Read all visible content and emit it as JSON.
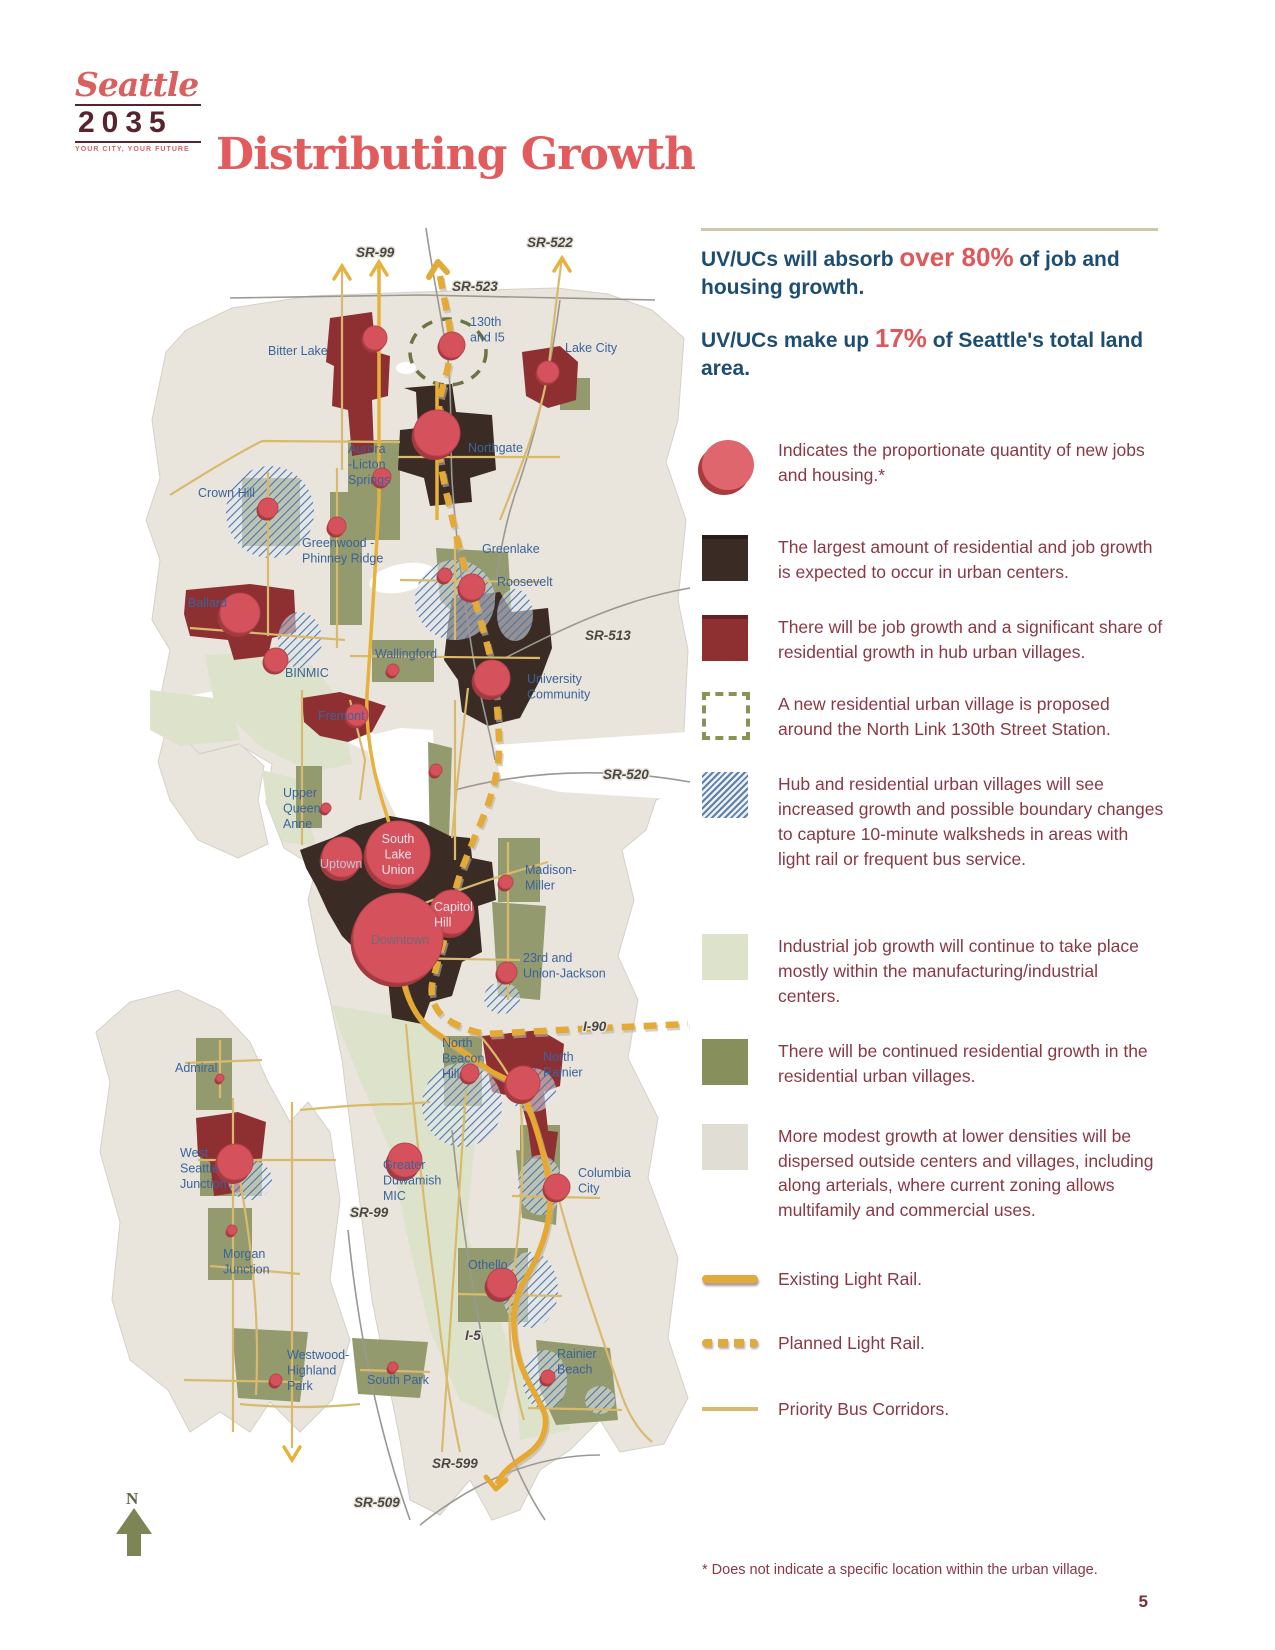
{
  "logo": {
    "brand": "Seattle",
    "year": "2035",
    "tagline": "YOUR CITY, YOUR FUTURE"
  },
  "header": {
    "title": "Distributing Growth"
  },
  "stats": [
    {
      "prefix": "UV/UCs will absorb ",
      "highlight": "over 80%",
      "suffix": " of job and housing growth."
    },
    {
      "prefix": "UV/UCs make up ",
      "highlight": "17%",
      "suffix": " of Seattle's total land area."
    }
  ],
  "legend": {
    "items": [
      {
        "type": "proportional-circle",
        "text": "Indicates the proportionate quantity of new jobs and housing.*"
      },
      {
        "type": "urban-center",
        "text": "The largest amount of residential and job growth is expected to occur in urban centers."
      },
      {
        "type": "hub-urban-village",
        "text": "There will be job growth and a significant share of residential growth in hub urban villages."
      },
      {
        "type": "proposed-village",
        "text": "A new residential urban village is proposed around the North Link 130th Street Station."
      },
      {
        "type": "boundary-change-hatch",
        "text": "Hub and residential urban villages will see increased growth and possible boundary changes to capture 10-minute walksheds in areas with light rail or frequent bus service."
      },
      {
        "type": "industrial-center",
        "text": "Industrial job growth will continue to take place mostly within the manufacturing/industrial centers."
      },
      {
        "type": "residential-urban-village",
        "text": "There will be continued residential growth in the residential urban villages."
      },
      {
        "type": "dispersed-growth",
        "text": "More modest growth at lower densities will be dispersed outside centers and villages, including along arterials, where current zoning allows multifamily and commercial uses."
      },
      {
        "type": "existing-light-rail",
        "text": "Existing Light Rail."
      },
      {
        "type": "planned-light-rail",
        "text": "Planned Light Rail."
      },
      {
        "type": "priority-bus",
        "text": "Priority Bus Corridors."
      }
    ]
  },
  "footnote": "* Does not indicate a specific location within the urban village.",
  "page": {
    "number": "5"
  },
  "map": {
    "compass": "N",
    "markers": [
      {
        "place": "bitter-lake",
        "x": 375,
        "y": 338,
        "r": 12
      },
      {
        "place": "130th-and-i5",
        "x": 452,
        "y": 345,
        "r": 13
      },
      {
        "place": "lake-city",
        "x": 548,
        "y": 372,
        "r": 11
      },
      {
        "place": "northgate",
        "x": 437,
        "y": 433,
        "r": 23
      },
      {
        "place": "aurora-licton-springs",
        "x": 382,
        "y": 477,
        "r": 9
      },
      {
        "place": "crown-hill",
        "x": 268,
        "y": 508,
        "r": 10
      },
      {
        "place": "greenwood-phinney-ridge",
        "x": 337,
        "y": 526,
        "r": 9
      },
      {
        "place": "greenlake",
        "x": 445,
        "y": 575,
        "r": 7
      },
      {
        "place": "roosevelt",
        "x": 472,
        "y": 587,
        "r": 13
      },
      {
        "place": "ballard",
        "x": 240,
        "y": 613,
        "r": 20
      },
      {
        "place": "binmic",
        "x": 276,
        "y": 660,
        "r": 12
      },
      {
        "place": "wallingford",
        "x": 393,
        "y": 670,
        "r": 6
      },
      {
        "place": "university-community",
        "x": 492,
        "y": 678,
        "r": 18
      },
      {
        "place": "fremont",
        "x": 357,
        "y": 715,
        "r": 11
      },
      {
        "place": "eastlake",
        "x": 436,
        "y": 770,
        "r": 6
      },
      {
        "place": "upper-queen-anne",
        "x": 326,
        "y": 808,
        "r": 5
      },
      {
        "place": "uptown",
        "x": 342,
        "y": 857,
        "r": 20
      },
      {
        "place": "south-lake-union",
        "x": 398,
        "y": 853,
        "r": 32
      },
      {
        "place": "madison-miller",
        "x": 506,
        "y": 882,
        "r": 7
      },
      {
        "place": "capitol-hill",
        "x": 452,
        "y": 912,
        "r": 22
      },
      {
        "place": "downtown",
        "x": 398,
        "y": 938,
        "r": 45
      },
      {
        "place": "23rd-and-union-jackson",
        "x": 507,
        "y": 972,
        "r": 10
      },
      {
        "place": "north-beacon-hill",
        "x": 470,
        "y": 1073,
        "r": 9
      },
      {
        "place": "north-rainier",
        "x": 523,
        "y": 1083,
        "r": 17
      },
      {
        "place": "admiral",
        "x": 220,
        "y": 1078,
        "r": 4
      },
      {
        "place": "west-seattle-junction",
        "x": 235,
        "y": 1162,
        "r": 18
      },
      {
        "place": "greater-duwamish-mic",
        "x": 405,
        "y": 1160,
        "r": 17
      },
      {
        "place": "morgan-junction",
        "x": 232,
        "y": 1230,
        "r": 5
      },
      {
        "place": "columbia-city",
        "x": 557,
        "y": 1187,
        "r": 13
      },
      {
        "place": "othello",
        "x": 502,
        "y": 1283,
        "r": 15
      },
      {
        "place": "westwood-highland-park",
        "x": 276,
        "y": 1380,
        "r": 6
      },
      {
        "place": "south-park",
        "x": 393,
        "y": 1367,
        "r": 5
      },
      {
        "place": "rainier-beach",
        "x": 548,
        "y": 1377,
        "r": 7
      }
    ],
    "labels": [
      {
        "place": "bitter-lake",
        "lines": [
          "Bitter Lake"
        ],
        "x": 268,
        "y": 355
      },
      {
        "place": "130th-and-i5",
        "lines": [
          "130th",
          "and I5"
        ],
        "x": 470,
        "y": 326
      },
      {
        "place": "lake-city",
        "lines": [
          "Lake City"
        ],
        "x": 565,
        "y": 352
      },
      {
        "place": "northgate",
        "lines": [
          "Northgate"
        ],
        "x": 468,
        "y": 452
      },
      {
        "place": "aurora-licton-springs",
        "lines": [
          "Aurora",
          "-Licton",
          "Springs"
        ],
        "x": 348,
        "y": 453
      },
      {
        "place": "crown-hill",
        "lines": [
          "Crown Hill"
        ],
        "x": 198,
        "y": 497
      },
      {
        "place": "greenwood-phinney-ridge",
        "lines": [
          "Greenwood -",
          "Phinney Ridge"
        ],
        "x": 302,
        "y": 547
      },
      {
        "place": "greenlake",
        "lines": [
          "Greenlake"
        ],
        "x": 482,
        "y": 553
      },
      {
        "place": "roosevelt",
        "lines": [
          "Roosevelt"
        ],
        "x": 497,
        "y": 586
      },
      {
        "place": "ballard",
        "lines": [
          "Ballard"
        ],
        "x": 188,
        "y": 607
      },
      {
        "place": "binmic",
        "lines": [
          "BINMIC"
        ],
        "x": 285,
        "y": 677
      },
      {
        "place": "wallingford",
        "lines": [
          "Wallingford"
        ],
        "x": 375,
        "y": 658
      },
      {
        "place": "university-community",
        "lines": [
          "University",
          "Community"
        ],
        "x": 527,
        "y": 683
      },
      {
        "place": "fremont",
        "lines": [
          "Fremont"
        ],
        "x": 318,
        "y": 720
      },
      {
        "place": "upper-queen-anne",
        "lines": [
          "Upper",
          "Queen",
          "Anne"
        ],
        "x": 283,
        "y": 797
      },
      {
        "place": "uptown",
        "lines": [
          "Uptown"
        ],
        "x": 320,
        "y": 868,
        "style": "light2"
      },
      {
        "place": "south-lake-union",
        "lines": [
          "South",
          "Lake",
          "Union"
        ],
        "x": 398,
        "y": 843,
        "style": "light",
        "anchor": "middle"
      },
      {
        "place": "madison-miller",
        "lines": [
          "Madison-",
          "Miller"
        ],
        "x": 525,
        "y": 874
      },
      {
        "place": "capitol-hill",
        "lines": [
          "Capitol",
          "Hill"
        ],
        "x": 434,
        "y": 911,
        "style": "light"
      },
      {
        "place": "downtown",
        "lines": [
          "Downtown"
        ],
        "x": 371,
        "y": 944,
        "style": "muted"
      },
      {
        "place": "23rd-and-union-jackson",
        "lines": [
          "23rd and",
          "Union-Jackson"
        ],
        "x": 523,
        "y": 962
      },
      {
        "place": "north-beacon-hill",
        "lines": [
          "North",
          "Beacon",
          "Hill"
        ],
        "x": 442,
        "y": 1047
      },
      {
        "place": "north-rainier",
        "lines": [
          "North",
          "Rainier"
        ],
        "x": 543,
        "y": 1061
      },
      {
        "place": "admiral",
        "lines": [
          "Admiral"
        ],
        "x": 175,
        "y": 1072
      },
      {
        "place": "west-seattle-junction",
        "lines": [
          "West",
          "Seattle",
          "Junction"
        ],
        "x": 180,
        "y": 1157
      },
      {
        "place": "greater-duwamish-mic",
        "lines": [
          "Greater",
          "Duwamish",
          "MIC"
        ],
        "x": 383,
        "y": 1169
      },
      {
        "place": "morgan-junction",
        "lines": [
          "Morgan",
          "Junction"
        ],
        "x": 223,
        "y": 1258
      },
      {
        "place": "columbia-city",
        "lines": [
          "Columbia",
          "City"
        ],
        "x": 578,
        "y": 1177
      },
      {
        "place": "othello",
        "lines": [
          "Othello"
        ],
        "x": 468,
        "y": 1269
      },
      {
        "place": "westwood-highland-park",
        "lines": [
          "Westwood-",
          "Highland",
          "Park"
        ],
        "x": 287,
        "y": 1359
      },
      {
        "place": "south-park",
        "lines": [
          "South Park"
        ],
        "x": 367,
        "y": 1384
      },
      {
        "place": "rainier-beach",
        "lines": [
          "Rainier",
          "Beach"
        ],
        "x": 557,
        "y": 1358
      }
    ],
    "road_labels": [
      {
        "text": "SR-99",
        "x": 356,
        "y": 257
      },
      {
        "text": "SR-522",
        "x": 527,
        "y": 247
      },
      {
        "text": "SR-523",
        "x": 452,
        "y": 291
      },
      {
        "text": "SR-513",
        "x": 585,
        "y": 640
      },
      {
        "text": "SR-520",
        "x": 603,
        "y": 779
      },
      {
        "text": "I-90",
        "x": 583,
        "y": 1031
      },
      {
        "text": "SR-99",
        "x": 350,
        "y": 1217
      },
      {
        "text": "I-5",
        "x": 465,
        "y": 1340
      },
      {
        "text": "SR-599",
        "x": 432,
        "y": 1468
      },
      {
        "text": "SR-509",
        "x": 354,
        "y": 1507
      }
    ]
  },
  "colors": {
    "accent_red": "#e0575a",
    "header_navy": "#1d4e72",
    "legend_text": "#8a3842",
    "map_label_blue": "#3a639c",
    "road_gold": "#e7b13d",
    "urban_center": "#3b2b25",
    "hub_urban_village": "#8e3031",
    "residential_village": "#87905c",
    "industrial": "#dde3cb",
    "dispersed": "#e0ddd5",
    "hatch_blue": "#4f76a4",
    "land": "#e9e5dd"
  }
}
